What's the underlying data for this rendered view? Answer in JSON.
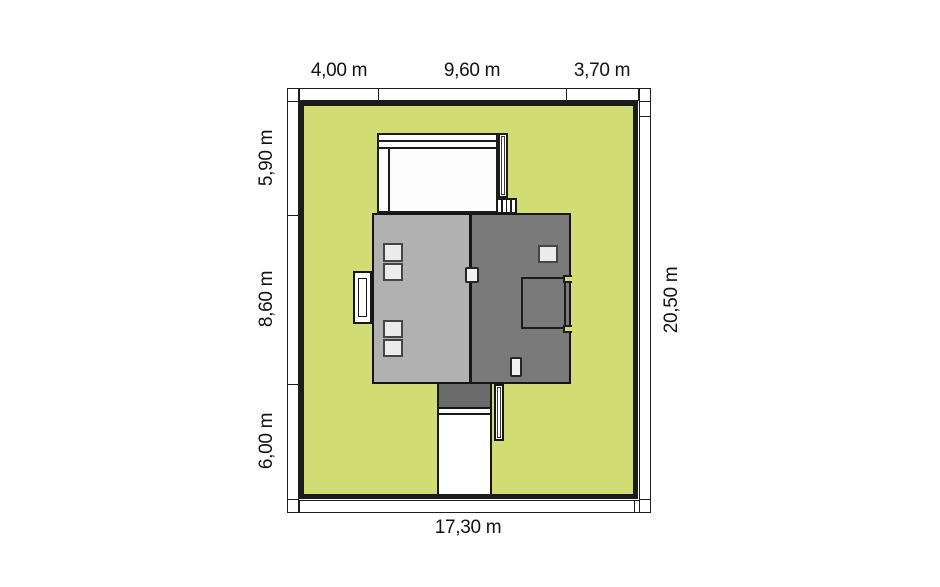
{
  "plan": {
    "type": "house-site-plan",
    "dims": {
      "top": [
        "4,00 m",
        "9,60 m",
        "3,70 m"
      ],
      "left": [
        "5,90 m",
        "8,60 m",
        "6,00 m"
      ],
      "right": "20,50 m",
      "bottom": "17,30 m"
    }
  },
  "colors": {
    "plot_green": "#d2dc74",
    "roof_light": "#b1b1b1",
    "roof_dark": "#7a7a7a",
    "canopy_gray": "#6b6b6b",
    "outline_black": "#1c1c1c",
    "skylight_fill": "#ececec",
    "background_white": "#ffffff"
  }
}
